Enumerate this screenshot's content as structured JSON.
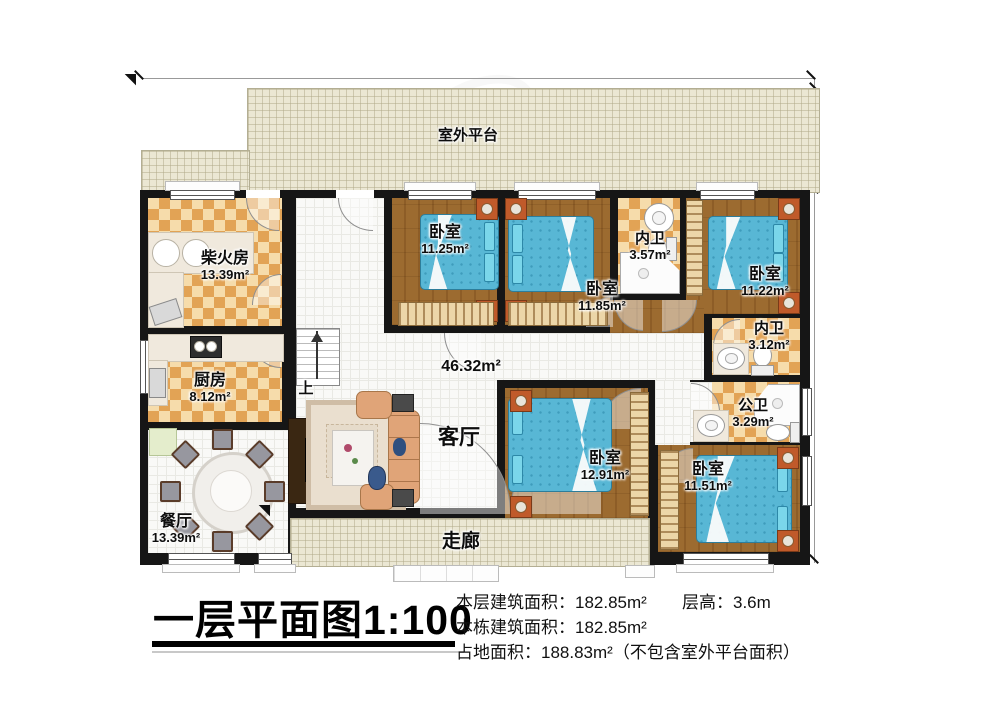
{
  "title": "一层平面图1:100",
  "stats": {
    "floor_area": "本层建筑面积：182.85m²",
    "story_height": "层高：3.6m",
    "building_area": "本栋建筑面积：182.85m²",
    "land_area": "占地面积：188.83m²（不包含室外平台面积）"
  },
  "dimensions": {
    "top_width": "18200",
    "platform_depth": "2880",
    "building_depth": "10000"
  },
  "labels": {
    "platform": "室外平台",
    "corridor": "走廊",
    "stairs_up": "上",
    "living_name": "客厅",
    "living_area": "46.32m²"
  },
  "rooms": {
    "firewood": {
      "name": "柴火房",
      "area": "13.39m²"
    },
    "kitchen": {
      "name": "厨房",
      "area": "8.12m²"
    },
    "dining": {
      "name": "餐厅",
      "area": "13.39m²"
    },
    "bedroom_nw": {
      "name": "卧室",
      "area": "11.25m²"
    },
    "bedroom_n": {
      "name": "卧室",
      "area": "11.85m²"
    },
    "bath_n": {
      "name": "内卫",
      "area": "3.57m²"
    },
    "bedroom_ne": {
      "name": "卧室",
      "area": "11.22m²"
    },
    "bath_e": {
      "name": "内卫",
      "area": "3.12m²"
    },
    "bath_public": {
      "name": "公卫",
      "area": "3.29m²"
    },
    "bedroom_s": {
      "name": "卧室",
      "area": "12.91m²"
    },
    "bedroom_se": {
      "name": "卧室",
      "area": "11.51m²"
    }
  },
  "colors": {
    "wall": "#161616",
    "checker_dark": "#e2a355",
    "checker_light": "#f6dcab",
    "wood_floor": "#9c6b30",
    "bed": "#58b7d5",
    "platform": "#ebe7d3"
  }
}
